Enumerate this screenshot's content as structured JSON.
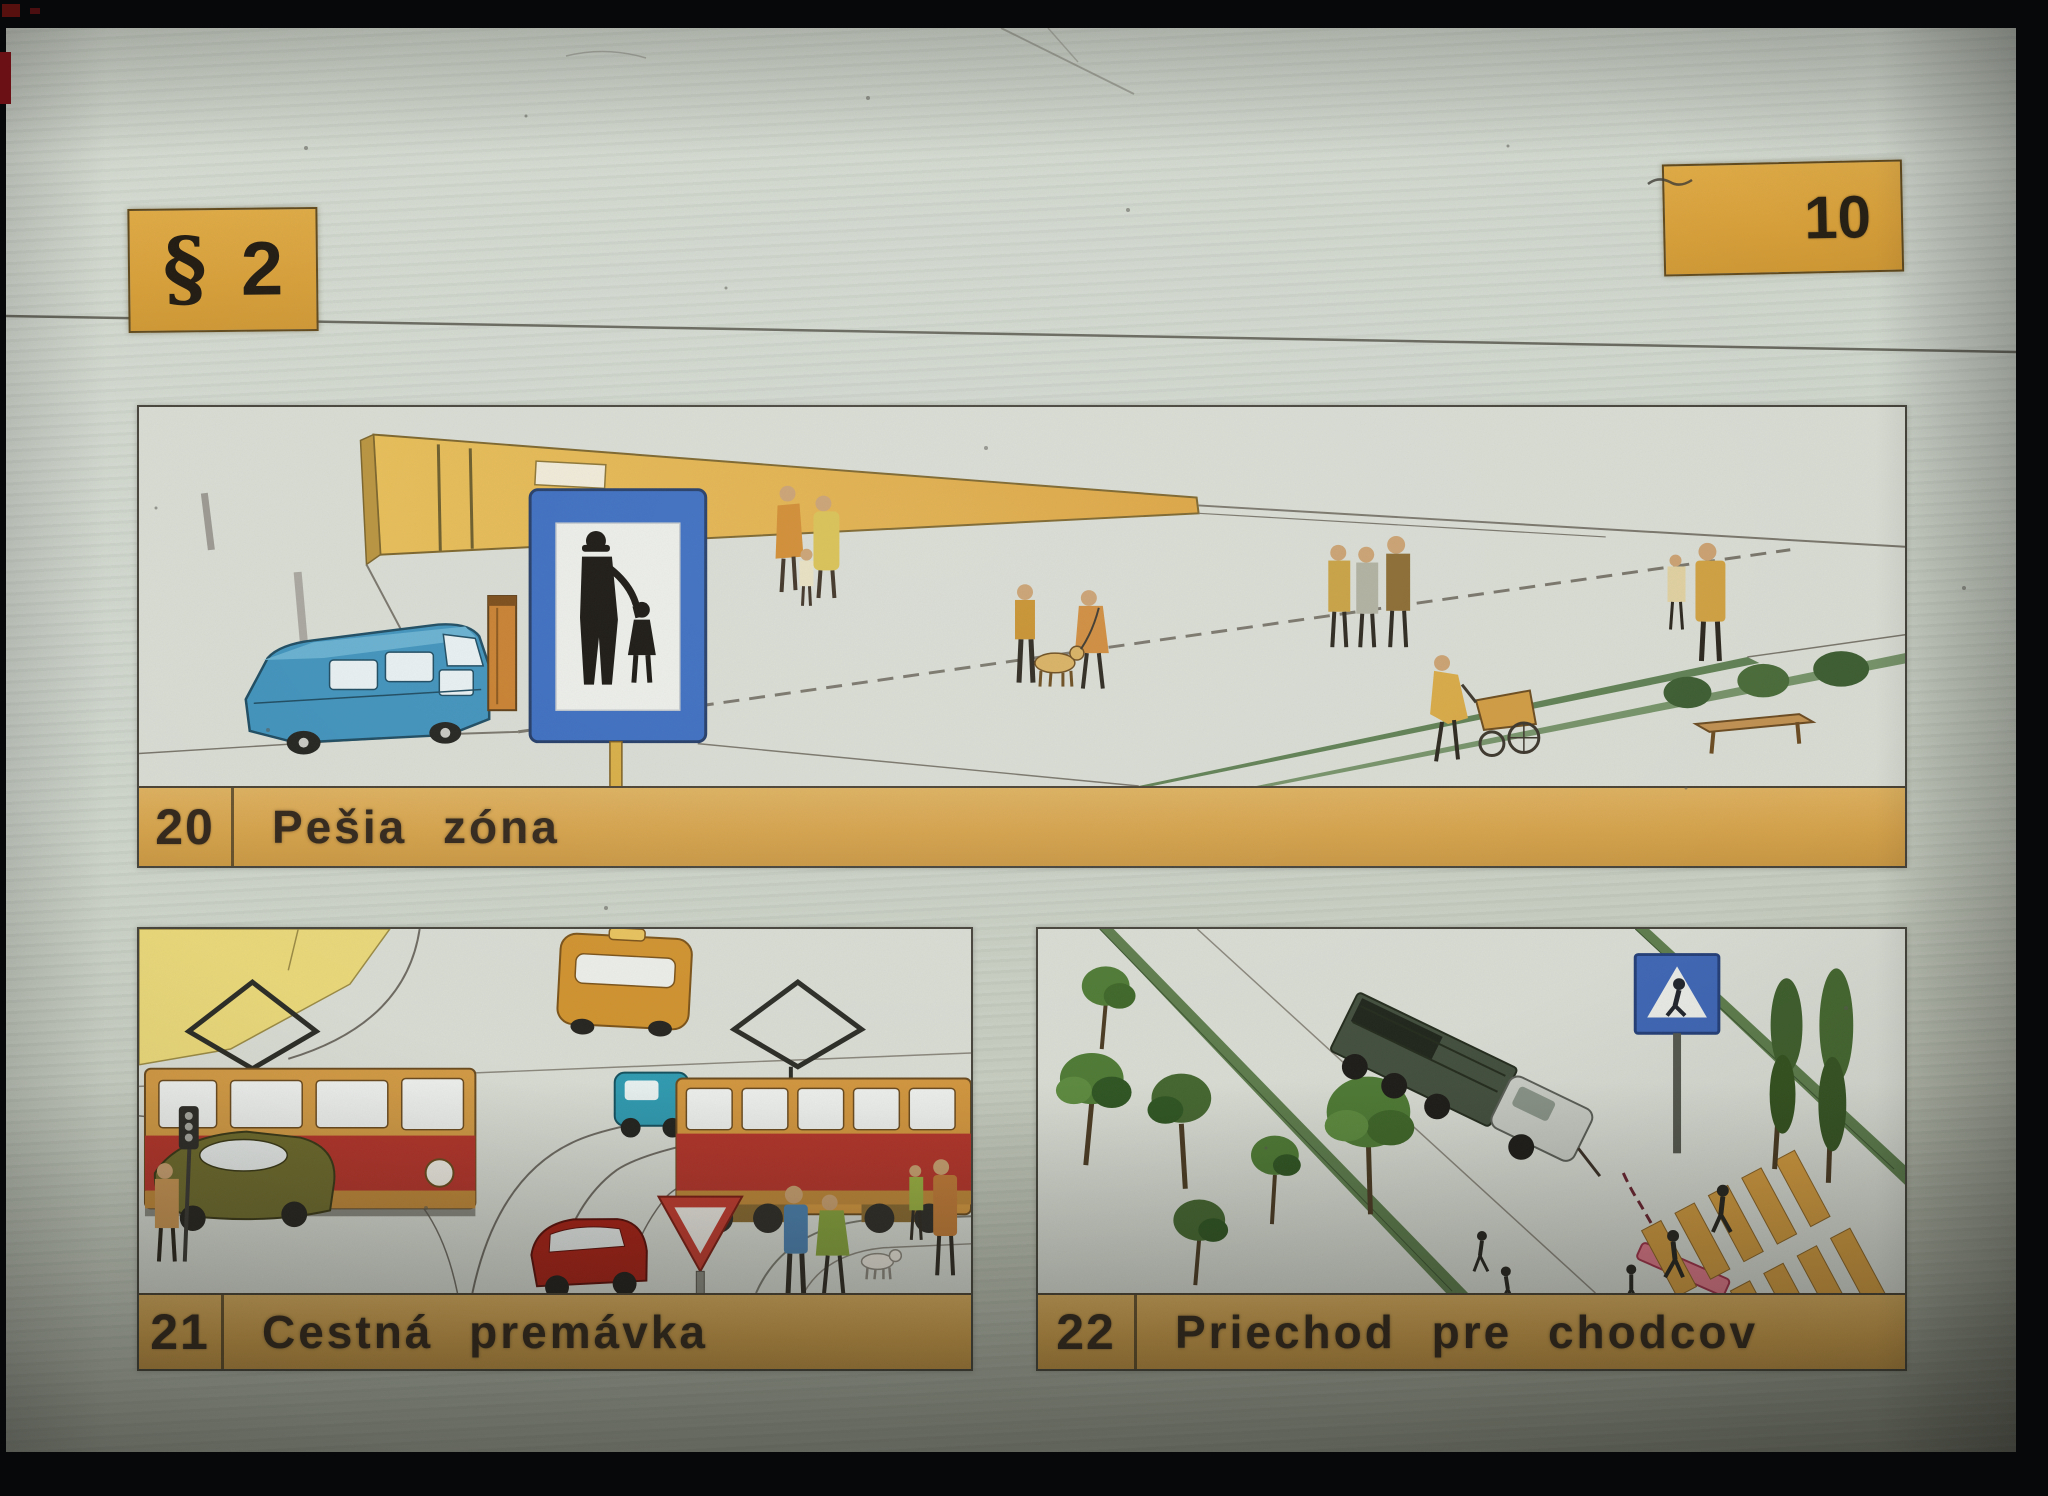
{
  "slide": {
    "section_badge": {
      "symbol": "§",
      "number": "2"
    },
    "page_number": "10",
    "panels": [
      {
        "number": "20",
        "title": "Pešia zóna"
      },
      {
        "number": "21",
        "title": "Cestná premávka"
      },
      {
        "number": "22",
        "title": "Priechod pre chodcov"
      }
    ],
    "colors": {
      "caption_bar": "#d5a24a",
      "badge": "#d89f38",
      "sign_blue": "#3a6cc0",
      "tram_red": "#b5342a",
      "tram_tan": "#d29a44",
      "van_blue": "#3f92bc",
      "grass_green": "#5f7f52",
      "crossing_orange": "#d29a3e",
      "slide_surface": "#cfd6cc"
    }
  }
}
